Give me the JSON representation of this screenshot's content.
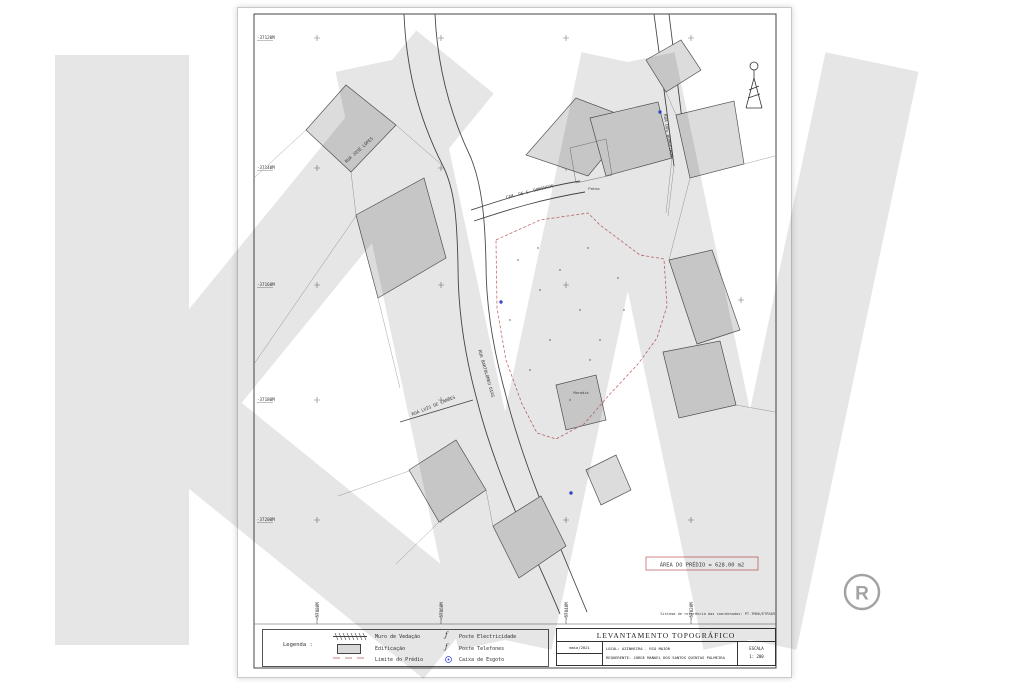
{
  "watermark": {
    "logo_text": "KW",
    "registered_mark": "®",
    "color": "#e6e6e6",
    "registered_color": "#a3a3a3"
  },
  "sheet": {
    "grid": {
      "left_labels": [
        "-37120M",
        "-37140M",
        "-37160M",
        "-37180M",
        "-37200M"
      ],
      "bottom_labels": [
        "-57080M",
        "-57060M",
        "-57040M",
        "-57020M"
      ]
    },
    "streets": [
      {
        "name": "RUA JOSÉ LOPES"
      },
      {
        "name": "CAM. DE S. DOMINGOS"
      },
      {
        "name": "RUA DOS BOMBEIROS"
      },
      {
        "name": "RUA BARTOLOMEU DIAS"
      },
      {
        "name": "RUA LUIS DE CAMÕES"
      }
    ],
    "labels": {
      "pateo": "Pateo",
      "moradia": "Moradia",
      "area_box": "ÁREA DO PRÉDIO = 628.00 m2",
      "datum_note": "Sistema de referência das coordenadas: PT-TM06/ETRS89"
    },
    "colors": {
      "boundary": "#c96a6a",
      "area_text": "#b05a5a",
      "building_fill": "#dcdcdc",
      "sewer_dot": "#3a4bd8"
    }
  },
  "legend": {
    "title": "Legenda :",
    "items": [
      {
        "label": "Muro de Vedação"
      },
      {
        "label": "Edificação"
      },
      {
        "label": "Limite do Prédio"
      },
      {
        "label": "Poste Electricidade"
      },
      {
        "label": "Poste Telefones"
      },
      {
        "label": "Caixa de Esgoto"
      }
    ]
  },
  "title_block": {
    "title": "LEVANTAMENTO TOPOGRÁFICO",
    "date": "maio/2021",
    "local": "LOCAL: AZINHEIRA  -  RIO MAIOR",
    "requester": "REQUERENTE:  JORGE MANUEL DOS SANTOS QUINTAS PALMEIRA",
    "scale_label": "ESCALA",
    "scale_value": "1: 200"
  }
}
